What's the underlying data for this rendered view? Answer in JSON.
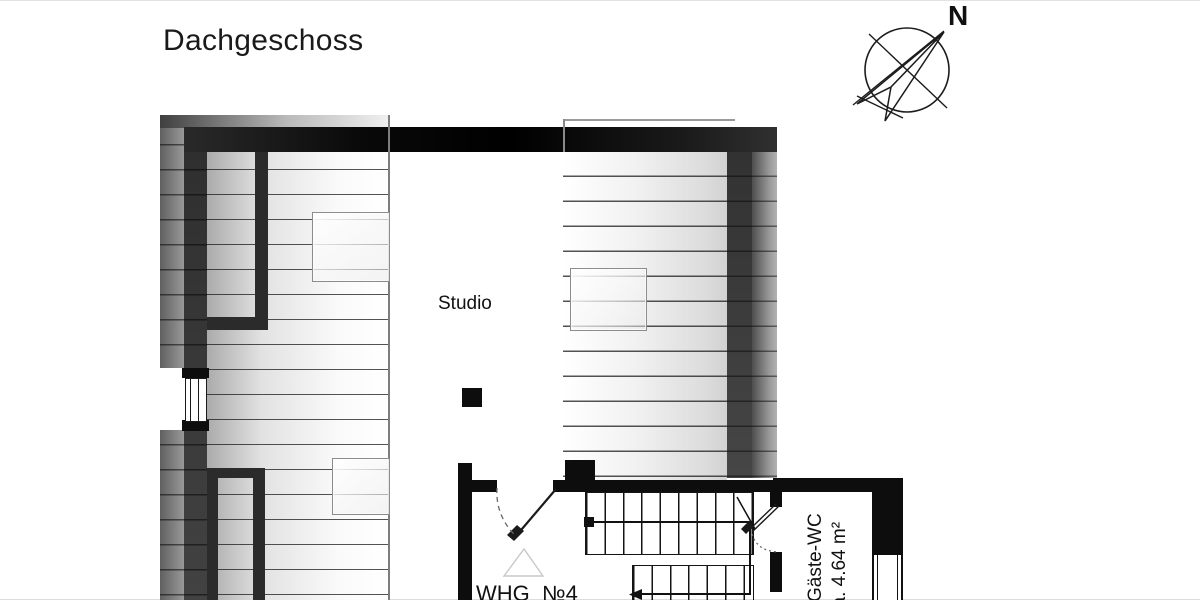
{
  "title": "Dachgeschoss",
  "compass": {
    "label": "N"
  },
  "rooms": {
    "studio": "Studio",
    "apartment": "WHG  №4",
    "guest_wc": {
      "name": "Gäste-WC",
      "area": "ca. 4.64 m²"
    }
  },
  "colors": {
    "background": "#ffffff",
    "wall_black": "#0d0d0d",
    "wall_dark_gray": "#3a3a3a",
    "wall_light_gray": "#9a9a9a",
    "roof_hatch_line": "#2a2a2a",
    "skylight_border": "#8c8c8c"
  }
}
